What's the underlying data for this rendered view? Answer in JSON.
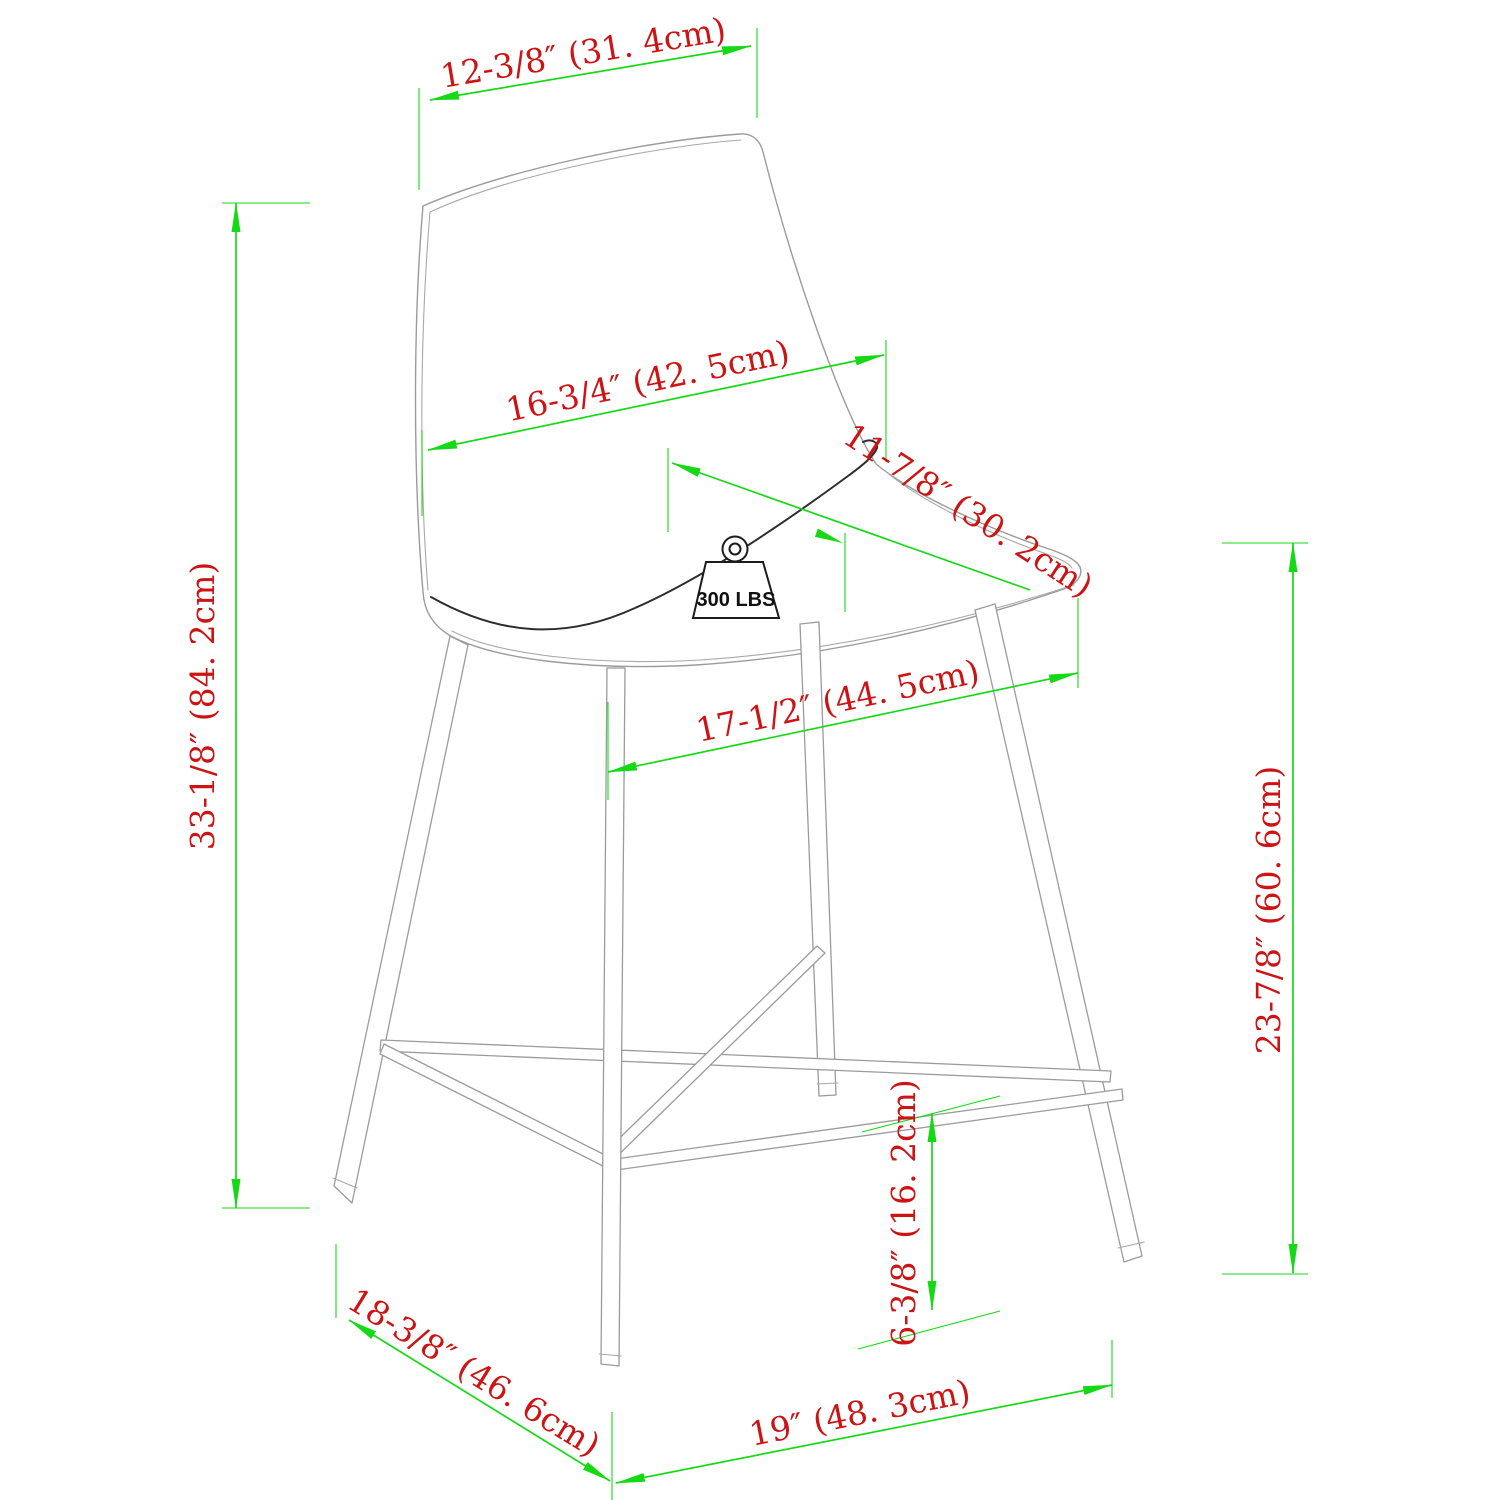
{
  "diagram": {
    "type": "product-dimension-drawing",
    "product": "counter height bar stool",
    "weight_capacity": {
      "label": "300 LBS",
      "value": 300,
      "unit": "LBS"
    },
    "colors": {
      "dimension_line": "#16d916",
      "dimension_text": "#cc1414",
      "chair_outline": "#9b9b9b",
      "seam": "#2e2e2e",
      "background": "#ffffff"
    },
    "dimensions": [
      {
        "id": "back-top-width",
        "label": "12-3/8″ (31. 4cm)",
        "inches": "12-3/8",
        "cm": 31.4,
        "orientation": "slanted-top"
      },
      {
        "id": "back-width",
        "label": "16-3/4″ (42. 5cm)",
        "inches": "16-3/4",
        "cm": 42.5,
        "orientation": "slanted"
      },
      {
        "id": "seat-depth",
        "label": "11-7/8″ (30. 2cm)",
        "inches": "11-7/8",
        "cm": 30.2,
        "orientation": "diagonal"
      },
      {
        "id": "seat-width",
        "label": "17-1/2″ (44. 5cm)",
        "inches": "17-1/2",
        "cm": 44.5,
        "orientation": "slanted"
      },
      {
        "id": "overall-height",
        "label": "33-1/8″ (84. 2cm)",
        "inches": "33-1/8",
        "cm": 84.2,
        "orientation": "vertical-left"
      },
      {
        "id": "seat-height",
        "label": "23-7/8″ (60. 6cm)",
        "inches": "23-7/8",
        "cm": 60.6,
        "orientation": "vertical-right"
      },
      {
        "id": "footrest-height",
        "label": "6-3/8″ (16. 2cm)",
        "inches": "6-3/8",
        "cm": 16.2,
        "orientation": "vertical-inner"
      },
      {
        "id": "base-depth",
        "label": "18-3/8″ (46. 6cm)",
        "inches": "18-3/8",
        "cm": 46.6,
        "orientation": "slanted-bottom-left"
      },
      {
        "id": "base-width",
        "label": "19″ (48. 3cm)",
        "inches": "19",
        "cm": 48.3,
        "orientation": "slanted-bottom-right"
      }
    ]
  }
}
